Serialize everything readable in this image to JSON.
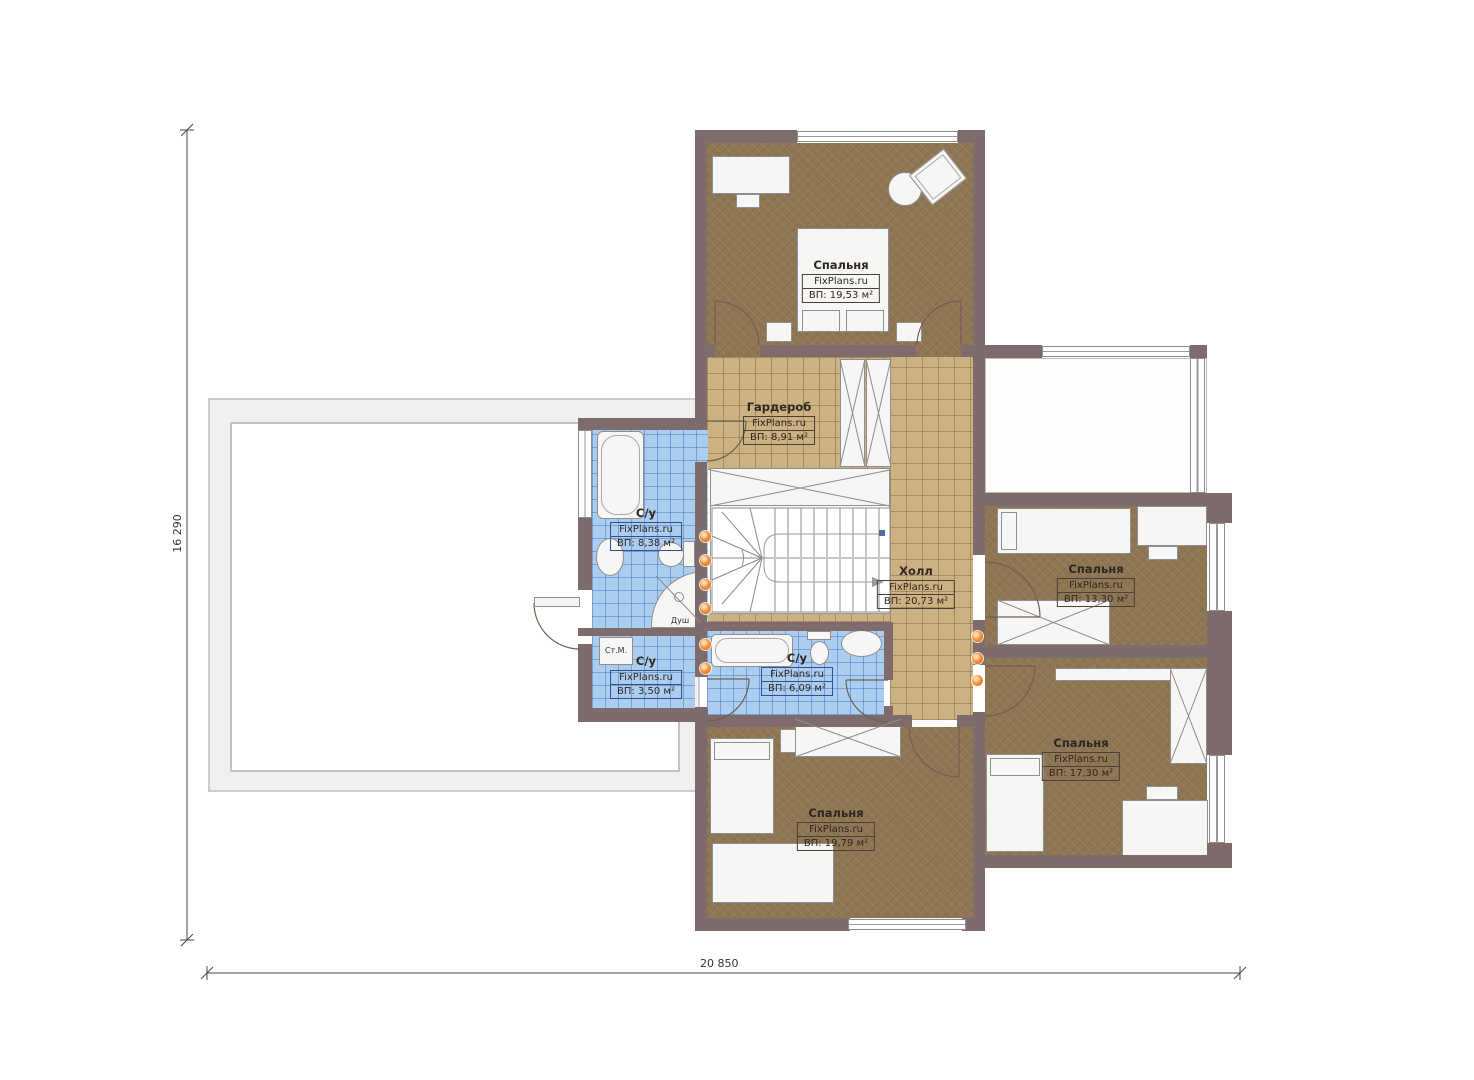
{
  "plan": {
    "brand": "FixPlans.ru",
    "rooms": [
      {
        "name": "Спальня",
        "brand": "FixPlans.ru",
        "area": "ВП: 19,53 м²"
      },
      {
        "name": "Гардероб",
        "brand": "FixPlans.ru",
        "area": "ВП: 8,91 м²"
      },
      {
        "name": "С/у",
        "brand": "FixPlans.ru",
        "area": "ВП: 8,38 м²"
      },
      {
        "name": "Холл",
        "brand": "FixPlans.ru",
        "area": "ВП: 20,73 м²"
      },
      {
        "name": "Спальня",
        "brand": "FixPlans.ru",
        "area": "ВП: 13,30 м²"
      },
      {
        "name": "С/у",
        "brand": "FixPlans.ru",
        "area": "ВП: 3,50 м²"
      },
      {
        "name": "С/у",
        "brand": "FixPlans.ru",
        "area": "ВП: 6,09 м²"
      },
      {
        "name": "Спальня",
        "brand": "FixPlans.ru",
        "area": "ВП: 17,30 м²"
      },
      {
        "name": "Спальня",
        "brand": "FixPlans.ru",
        "area": "ВП: 19,79 м²"
      }
    ],
    "annotations": {
      "washing_machine": "Ст.М.",
      "shower": "Душ"
    },
    "dimensions": {
      "height_mm": "16 290",
      "width_mm": "20 850"
    },
    "colors": {
      "wall": "#7e6b6c",
      "carpet": "#8e7553",
      "tile_tan": "#ccb183",
      "tile_blue": "#abcdf0",
      "heat_dot": "#f07820"
    }
  }
}
